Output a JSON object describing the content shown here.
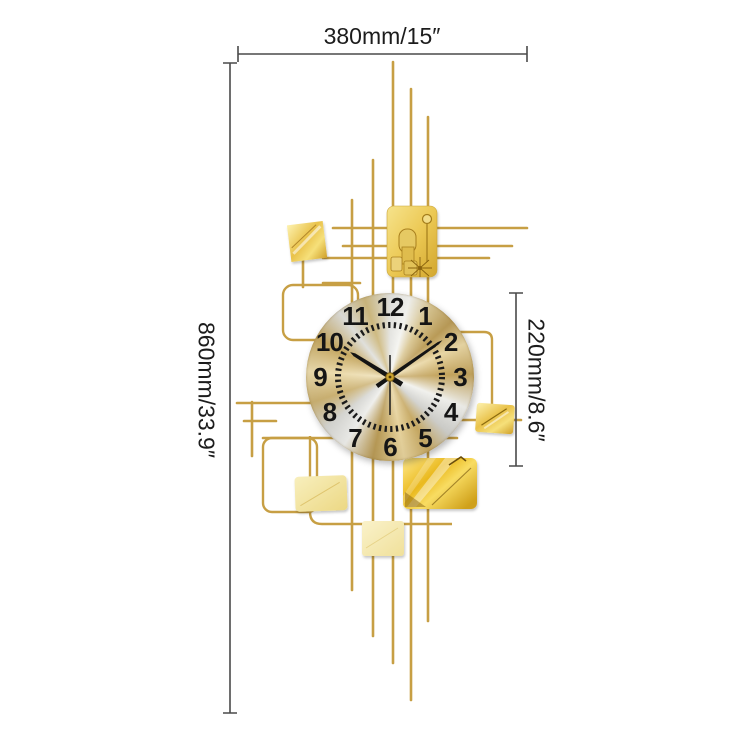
{
  "dimensions": {
    "width": "380mm/15″",
    "height": "860mm/33.9″",
    "clock_diameter": "220mm/8.6″"
  },
  "clock": {
    "numerals": [
      "12",
      "1",
      "2",
      "3",
      "4",
      "5",
      "6",
      "7",
      "8",
      "9",
      "10",
      "11"
    ],
    "hands": {
      "hour_deg": 302,
      "minute_deg": 55,
      "second_deg": 180
    }
  },
  "colors": {
    "rod_gold": "#c79f44",
    "bright_gold": "#eebc1f",
    "pale_gold": "#f4e9ab",
    "face_silver": "#ededea",
    "face_gold": "#c6a862",
    "numeral_black": "#151515",
    "dimension_line": "#4a4a4a"
  }
}
